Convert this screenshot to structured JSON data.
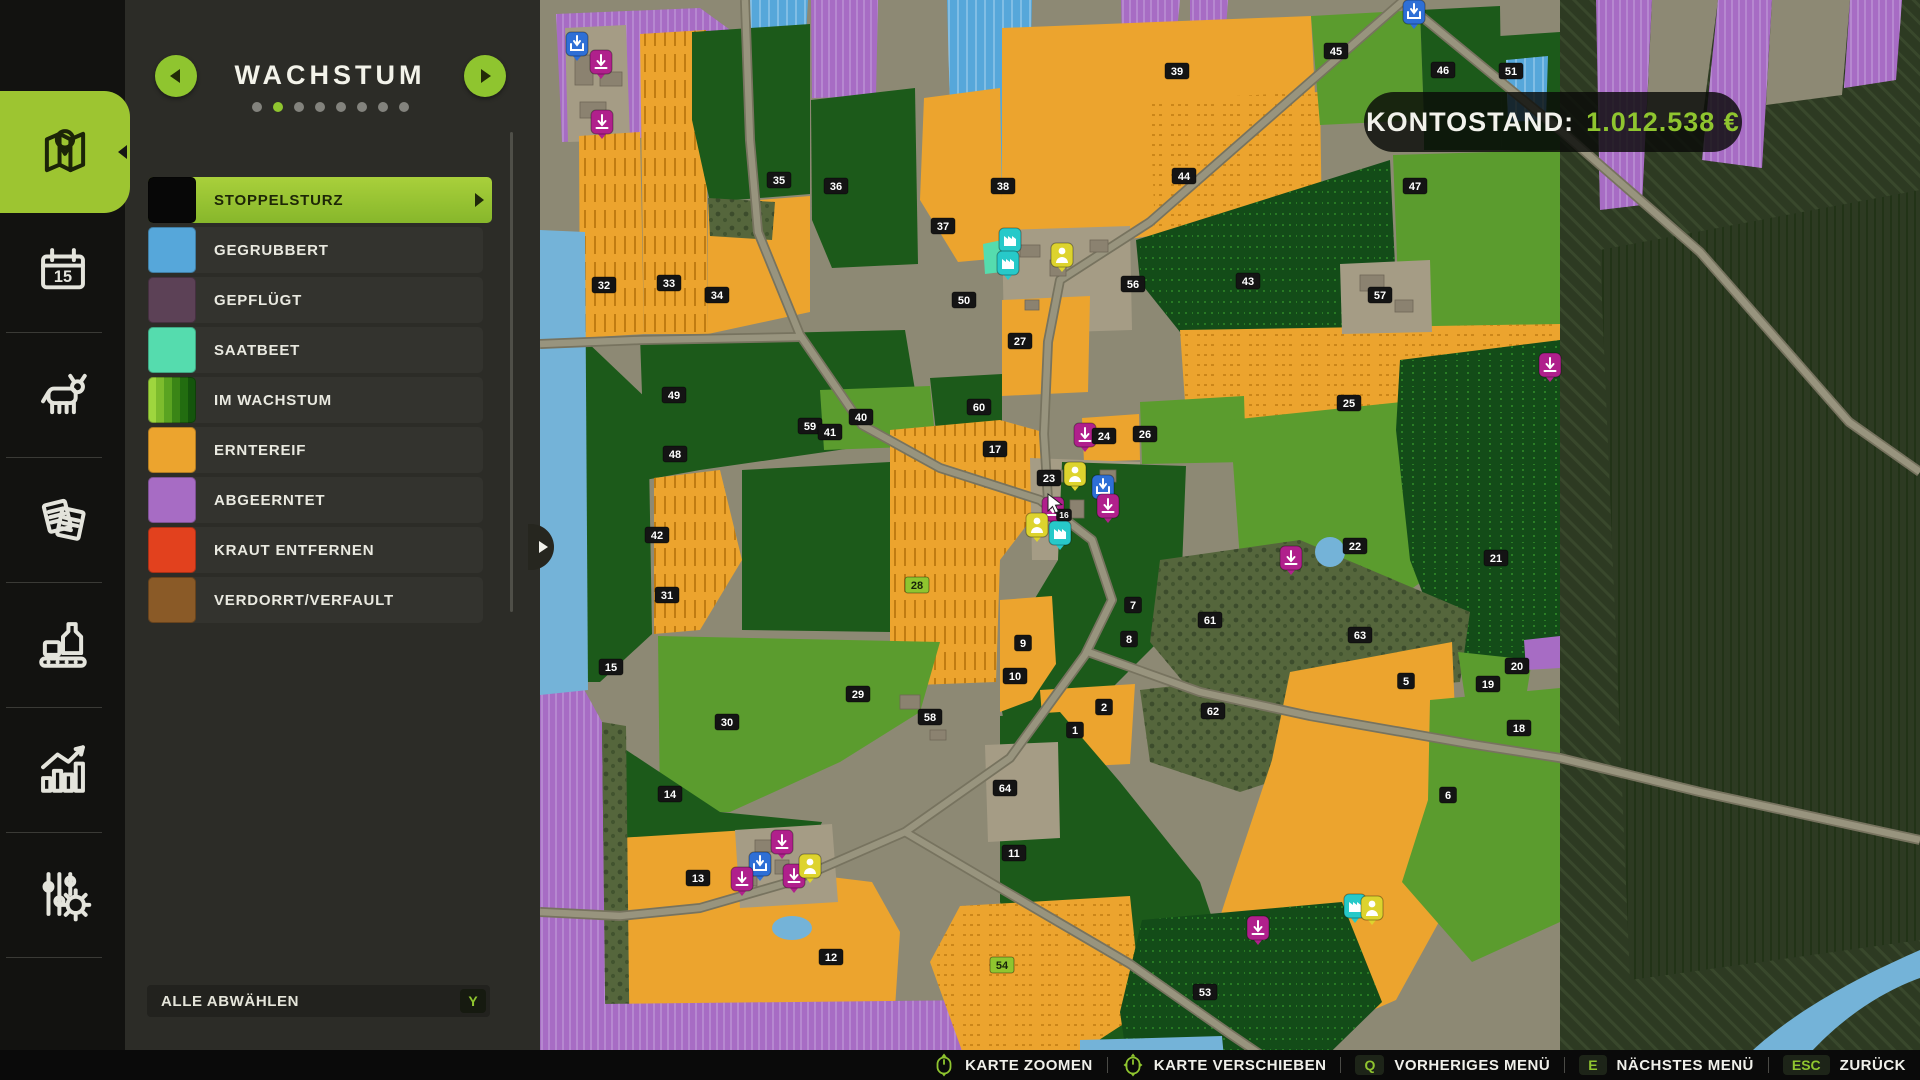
{
  "header": {
    "title": "WACHSTUM",
    "dots_total": 8,
    "dots_active": 1
  },
  "account": {
    "label": "KONTOSTAND:",
    "amount": "1.012.538 €"
  },
  "legend": {
    "items": [
      {
        "label": "STOPPELSTURZ",
        "color": "#070707",
        "selected": true
      },
      {
        "label": "GEGRUBBERT",
        "color": "#56a7da"
      },
      {
        "label": "GEPFLÜGT",
        "color": "#5c4156"
      },
      {
        "label": "SAATBEET",
        "color": "#55dcae"
      },
      {
        "label": "IM WACHSTUM",
        "stripes": [
          "#9ed63e",
          "#7dbc2d",
          "#5aa321",
          "#3a8516",
          "#226d10",
          "#14550c"
        ]
      },
      {
        "label": "ERNTEREIF",
        "color": "#eca42e"
      },
      {
        "label": "ABGEERNTET",
        "color": "#a76cc4"
      },
      {
        "label": "KRAUT ENTFERNEN",
        "color": "#e2411e"
      },
      {
        "label": "VERDORRT/VERFAULT",
        "color": "#8a5a27"
      }
    ],
    "deselect_all": {
      "label": "ALLE ABWÄHLEN",
      "key": "Y"
    }
  },
  "sidebar": {
    "items": [
      {
        "name": "map",
        "active": true
      },
      {
        "name": "calendar",
        "active": false
      },
      {
        "name": "animals",
        "active": false
      },
      {
        "name": "contracts",
        "active": false
      },
      {
        "name": "production",
        "active": false
      },
      {
        "name": "statistics",
        "active": false
      },
      {
        "name": "settings",
        "active": false
      }
    ]
  },
  "bottom_bar": {
    "actions": [
      {
        "icon": "mouse-scroll",
        "label": "KARTE ZOOMEN"
      },
      {
        "icon": "mouse-move",
        "label": "KARTE VERSCHIEBEN"
      },
      {
        "key": "Q",
        "label": "VORHERIGES MENÜ"
      },
      {
        "key": "E",
        "label": "NÄCHSTES MENÜ"
      },
      {
        "key": "ESC",
        "label": "ZURÜCK"
      }
    ]
  },
  "map": {
    "colors": {
      "base": "#8d8974",
      "forestDark": "#2d3a22",
      "forestMid": "#55663c",
      "orange": "#eca42e",
      "greenMid": "#5b9c2e",
      "greenDk": "#1c5a1a",
      "greenDeep": "#134c18",
      "purple": "#a76cc4",
      "blue": "#56a7da",
      "teal": "#55dcae",
      "water": "#74b3d8",
      "yard": "#a59c85",
      "road": "#98947e",
      "roadEdge": "#77735f",
      "building": "#8b8270",
      "label_bg": "#141414",
      "label_text": "#ffffff",
      "label_hl_bg": "#8fc52f",
      "label_hl_text": "#17230a",
      "icon_sell": "#b0208c",
      "icon_shop": "#2e6fd6",
      "icon_person": "#ddd32e",
      "icon_prod": "#27c9c9"
    },
    "field_labels": [
      {
        "n": "35",
        "x": 779,
        "y": 180
      },
      {
        "n": "36",
        "x": 836,
        "y": 186
      },
      {
        "n": "37",
        "x": 943,
        "y": 226
      },
      {
        "n": "50",
        "x": 964,
        "y": 300
      },
      {
        "n": "32",
        "x": 604,
        "y": 285
      },
      {
        "n": "33",
        "x": 669,
        "y": 283
      },
      {
        "n": "34",
        "x": 717,
        "y": 295
      },
      {
        "n": "49",
        "x": 674,
        "y": 395
      },
      {
        "n": "40",
        "x": 861,
        "y": 417
      },
      {
        "n": "60",
        "x": 979,
        "y": 407
      },
      {
        "n": "59",
        "x": 810,
        "y": 426
      },
      {
        "n": "41",
        "x": 830,
        "y": 432
      },
      {
        "n": "48",
        "x": 675,
        "y": 454
      },
      {
        "n": "42",
        "x": 657,
        "y": 535
      },
      {
        "n": "31",
        "x": 667,
        "y": 595
      },
      {
        "n": "15",
        "x": 611,
        "y": 667
      },
      {
        "n": "28",
        "x": 917,
        "y": 585,
        "hl": true
      },
      {
        "n": "29",
        "x": 858,
        "y": 694
      },
      {
        "n": "30",
        "x": 727,
        "y": 722
      },
      {
        "n": "58",
        "x": 930,
        "y": 717
      },
      {
        "n": "14",
        "x": 670,
        "y": 794
      },
      {
        "n": "13",
        "x": 698,
        "y": 878
      },
      {
        "n": "12",
        "x": 831,
        "y": 957
      },
      {
        "n": "17",
        "x": 995,
        "y": 449
      },
      {
        "n": "16",
        "x": 1064,
        "y": 515,
        "small": true
      },
      {
        "n": "23",
        "x": 1049,
        "y": 478
      },
      {
        "n": "24",
        "x": 1104,
        "y": 436
      },
      {
        "n": "26",
        "x": 1145,
        "y": 434
      },
      {
        "n": "39",
        "x": 1177,
        "y": 71
      },
      {
        "n": "45",
        "x": 1336,
        "y": 51
      },
      {
        "n": "46",
        "x": 1443,
        "y": 70
      },
      {
        "n": "51",
        "x": 1511,
        "y": 71
      },
      {
        "n": "44",
        "x": 1184,
        "y": 176
      },
      {
        "n": "38",
        "x": 1003,
        "y": 186
      },
      {
        "n": "47",
        "x": 1415,
        "y": 186
      },
      {
        "n": "43",
        "x": 1248,
        "y": 281
      },
      {
        "n": "56",
        "x": 1133,
        "y": 284
      },
      {
        "n": "57",
        "x": 1380,
        "y": 295
      },
      {
        "n": "27",
        "x": 1020,
        "y": 341
      },
      {
        "n": "25",
        "x": 1349,
        "y": 403
      },
      {
        "n": "22",
        "x": 1355,
        "y": 546
      },
      {
        "n": "21",
        "x": 1496,
        "y": 558
      },
      {
        "n": "7",
        "x": 1133,
        "y": 605
      },
      {
        "n": "61",
        "x": 1210,
        "y": 620
      },
      {
        "n": "8",
        "x": 1129,
        "y": 639
      },
      {
        "n": "63",
        "x": 1360,
        "y": 635
      },
      {
        "n": "9",
        "x": 1023,
        "y": 643
      },
      {
        "n": "10",
        "x": 1015,
        "y": 676
      },
      {
        "n": "2",
        "x": 1104,
        "y": 707
      },
      {
        "n": "1",
        "x": 1075,
        "y": 730
      },
      {
        "n": "62",
        "x": 1213,
        "y": 711
      },
      {
        "n": "5",
        "x": 1406,
        "y": 681
      },
      {
        "n": "19",
        "x": 1488,
        "y": 684
      },
      {
        "n": "20",
        "x": 1517,
        "y": 666
      },
      {
        "n": "18",
        "x": 1519,
        "y": 728
      },
      {
        "n": "6",
        "x": 1448,
        "y": 795
      },
      {
        "n": "64",
        "x": 1005,
        "y": 788
      },
      {
        "n": "11",
        "x": 1014,
        "y": 853
      },
      {
        "n": "54",
        "x": 1002,
        "y": 965,
        "hl": true
      },
      {
        "n": "53",
        "x": 1205,
        "y": 992
      }
    ],
    "icons": [
      {
        "t": "shop",
        "x": 577,
        "y": 44
      },
      {
        "t": "sell",
        "x": 601,
        "y": 62
      },
      {
        "t": "sell",
        "x": 602,
        "y": 122
      },
      {
        "t": "shop",
        "x": 1414,
        "y": 12
      },
      {
        "t": "prod",
        "x": 1010,
        "y": 240
      },
      {
        "t": "prod",
        "x": 1008,
        "y": 263
      },
      {
        "t": "person",
        "x": 1062,
        "y": 255
      },
      {
        "t": "sell",
        "x": 1550,
        "y": 365
      },
      {
        "t": "sell",
        "x": 1085,
        "y": 435
      },
      {
        "t": "person",
        "x": 1075,
        "y": 474
      },
      {
        "t": "shop",
        "x": 1103,
        "y": 487
      },
      {
        "t": "sell",
        "x": 1108,
        "y": 506
      },
      {
        "t": "sell",
        "x": 1053,
        "y": 509
      },
      {
        "t": "person",
        "x": 1037,
        "y": 525
      },
      {
        "t": "prod",
        "x": 1060,
        "y": 533
      },
      {
        "t": "sell",
        "x": 1291,
        "y": 558
      },
      {
        "t": "sell",
        "x": 782,
        "y": 842
      },
      {
        "t": "shop",
        "x": 760,
        "y": 864
      },
      {
        "t": "sell",
        "x": 742,
        "y": 879
      },
      {
        "t": "sell",
        "x": 794,
        "y": 876
      },
      {
        "t": "person",
        "x": 810,
        "y": 866
      },
      {
        "t": "sell",
        "x": 1258,
        "y": 928
      },
      {
        "t": "prod",
        "x": 1355,
        "y": 906
      },
      {
        "t": "person",
        "x": 1372,
        "y": 908
      }
    ],
    "cursor": {
      "x": 1048,
      "y": 500
    }
  }
}
